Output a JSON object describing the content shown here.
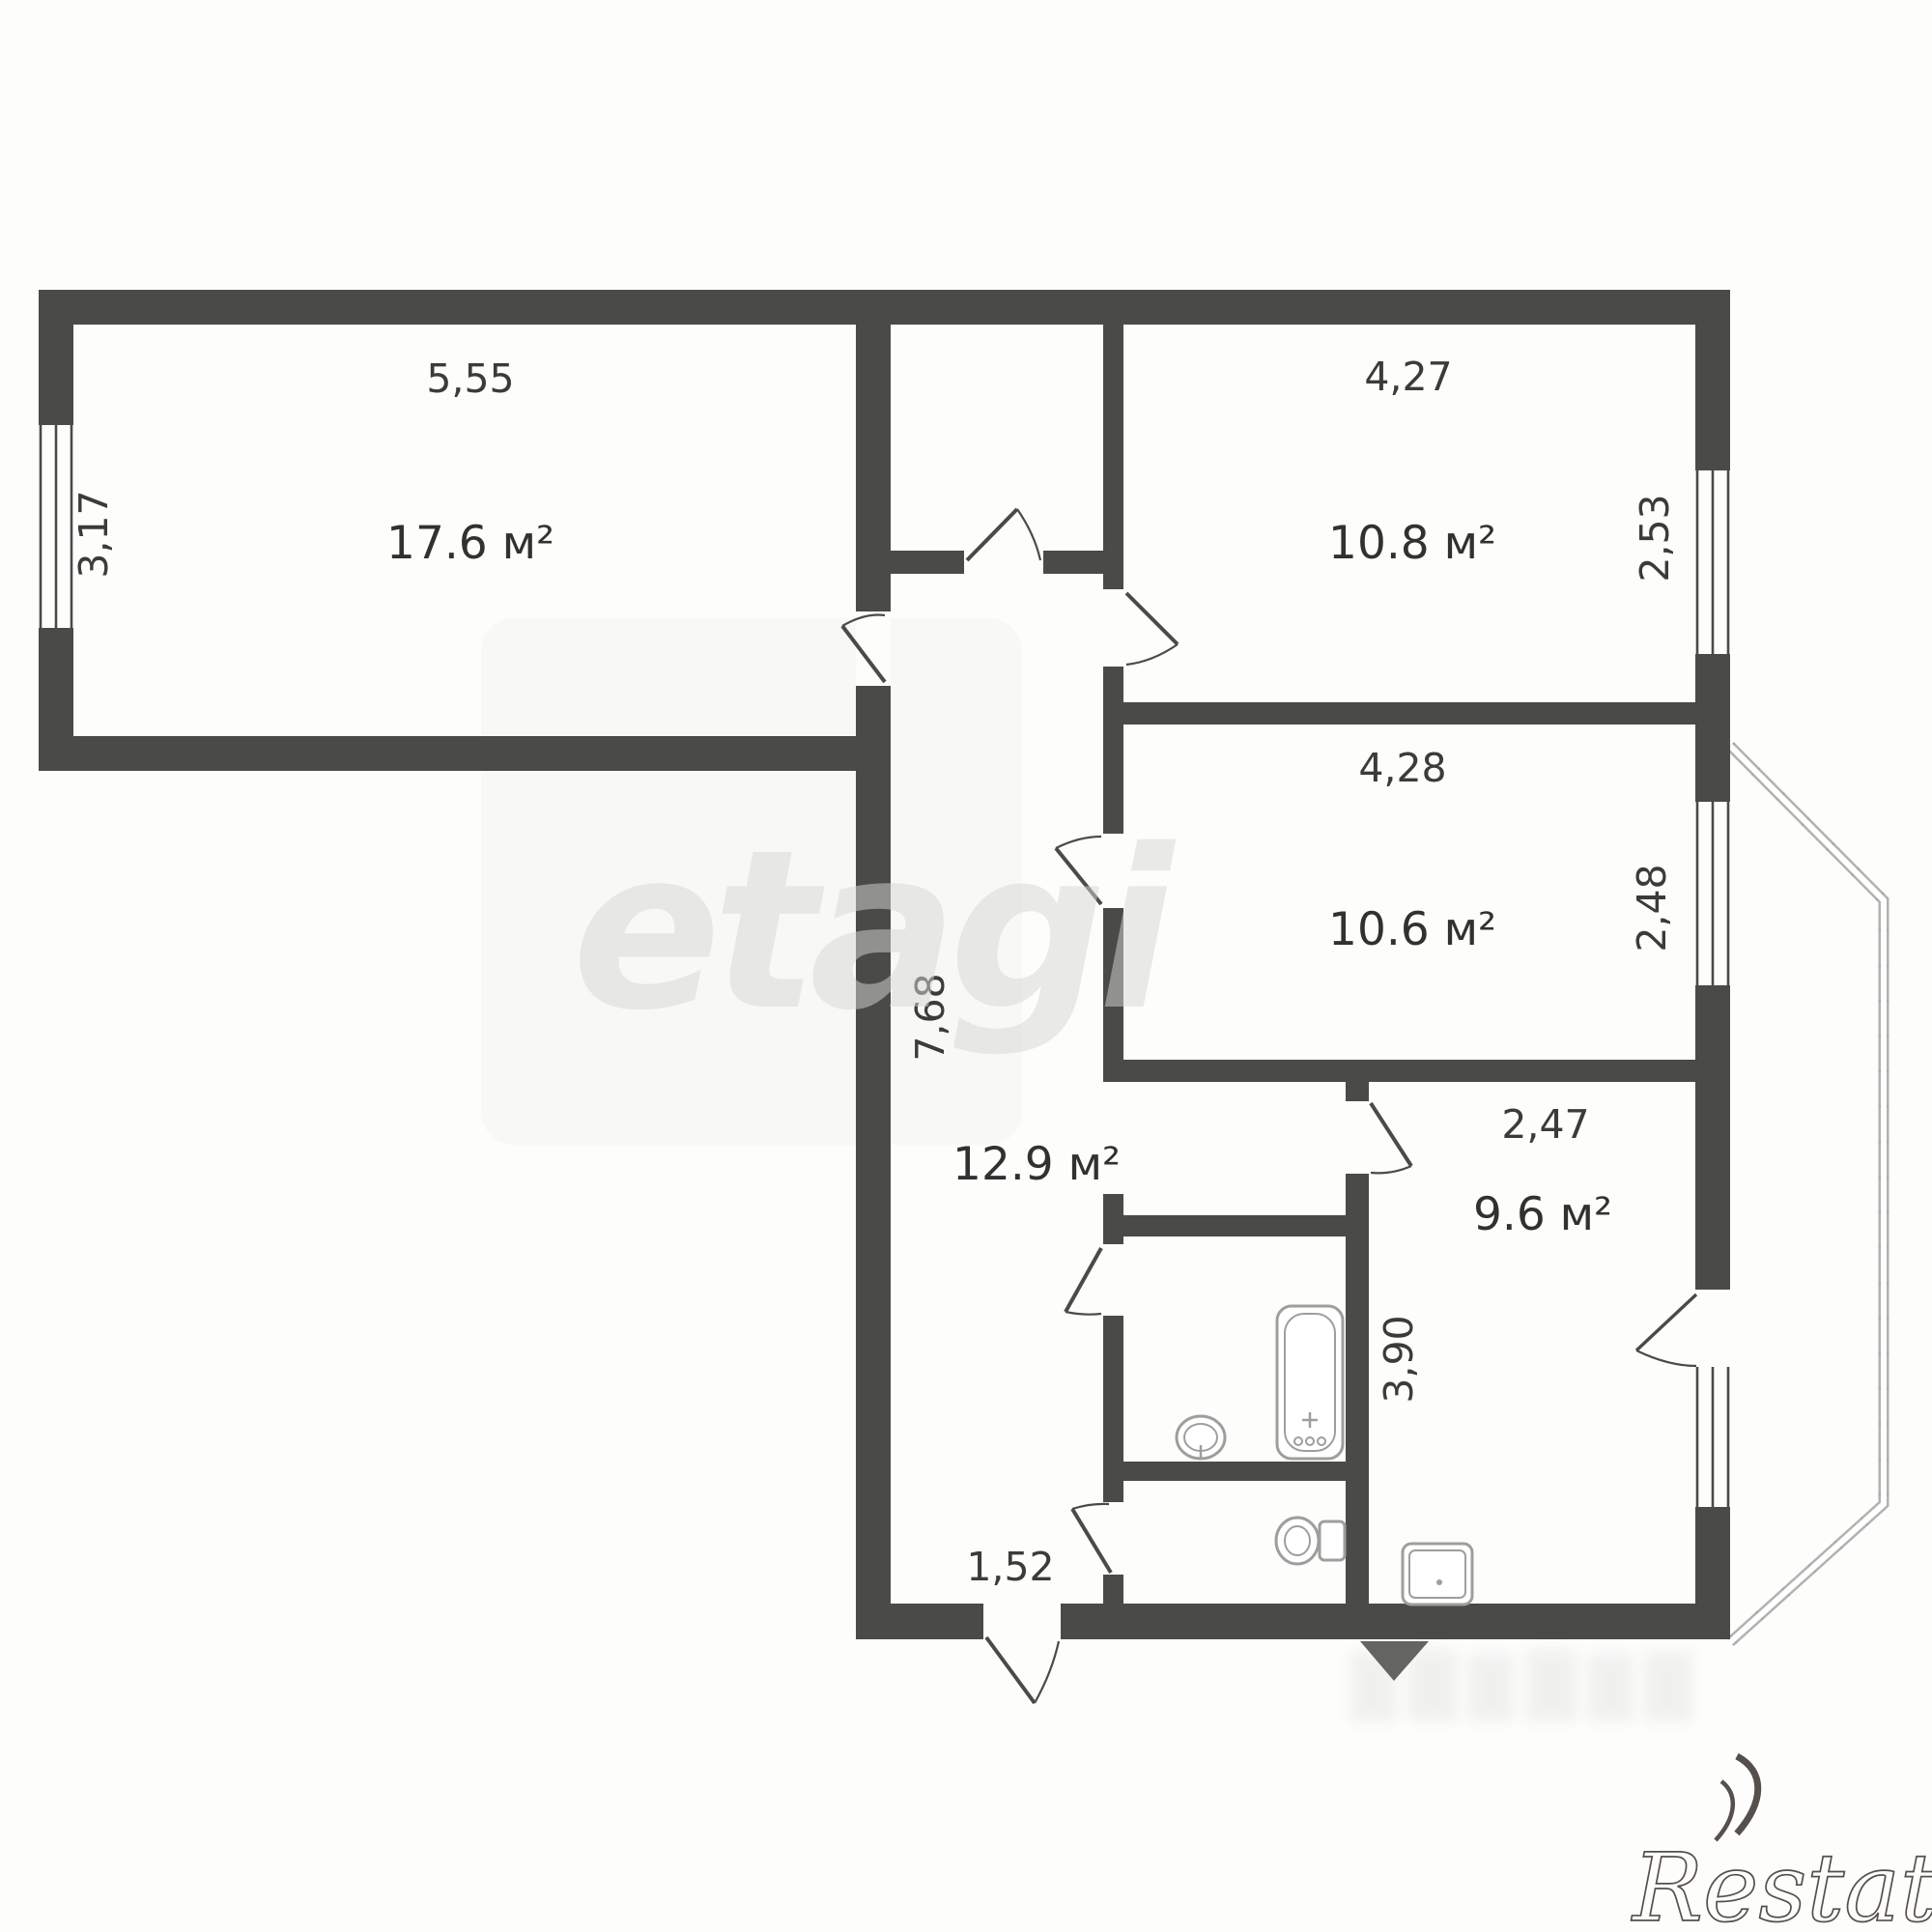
{
  "document": {
    "type": "apartment-floor-plan",
    "units": "meters"
  },
  "rooms": [
    {
      "id": "living-room",
      "area": "17.6 м²",
      "width": "5,55",
      "height": "3,17"
    },
    {
      "id": "bedroom-top",
      "area": "10.8 м²",
      "width": "4,27",
      "height": "2,53"
    },
    {
      "id": "bedroom-mid",
      "area": "10.6 м²",
      "width": "4,28",
      "height": "2,48"
    },
    {
      "id": "hallway",
      "area": "12.9 м²",
      "length": "7,68"
    },
    {
      "id": "kitchen",
      "area": "9.6 м²",
      "width": "2,47",
      "height": "3,90"
    }
  ],
  "entry": {
    "door_width": "1,52"
  },
  "fixtures": [
    "bathtub",
    "wash-basin",
    "toilet",
    "kitchen-sink"
  ],
  "features": [
    "balcony",
    "windows",
    "interior-doors",
    "entrance-arrow"
  ],
  "watermarks": {
    "center": "etagi",
    "brand": "Restate"
  },
  "colors": {
    "wall": "#4a4a48",
    "background": "#fdfdfc",
    "label": "#3b3b3a",
    "fixture_outline": "#9e9e9c",
    "balcony_rail": "#b2b2b0"
  }
}
